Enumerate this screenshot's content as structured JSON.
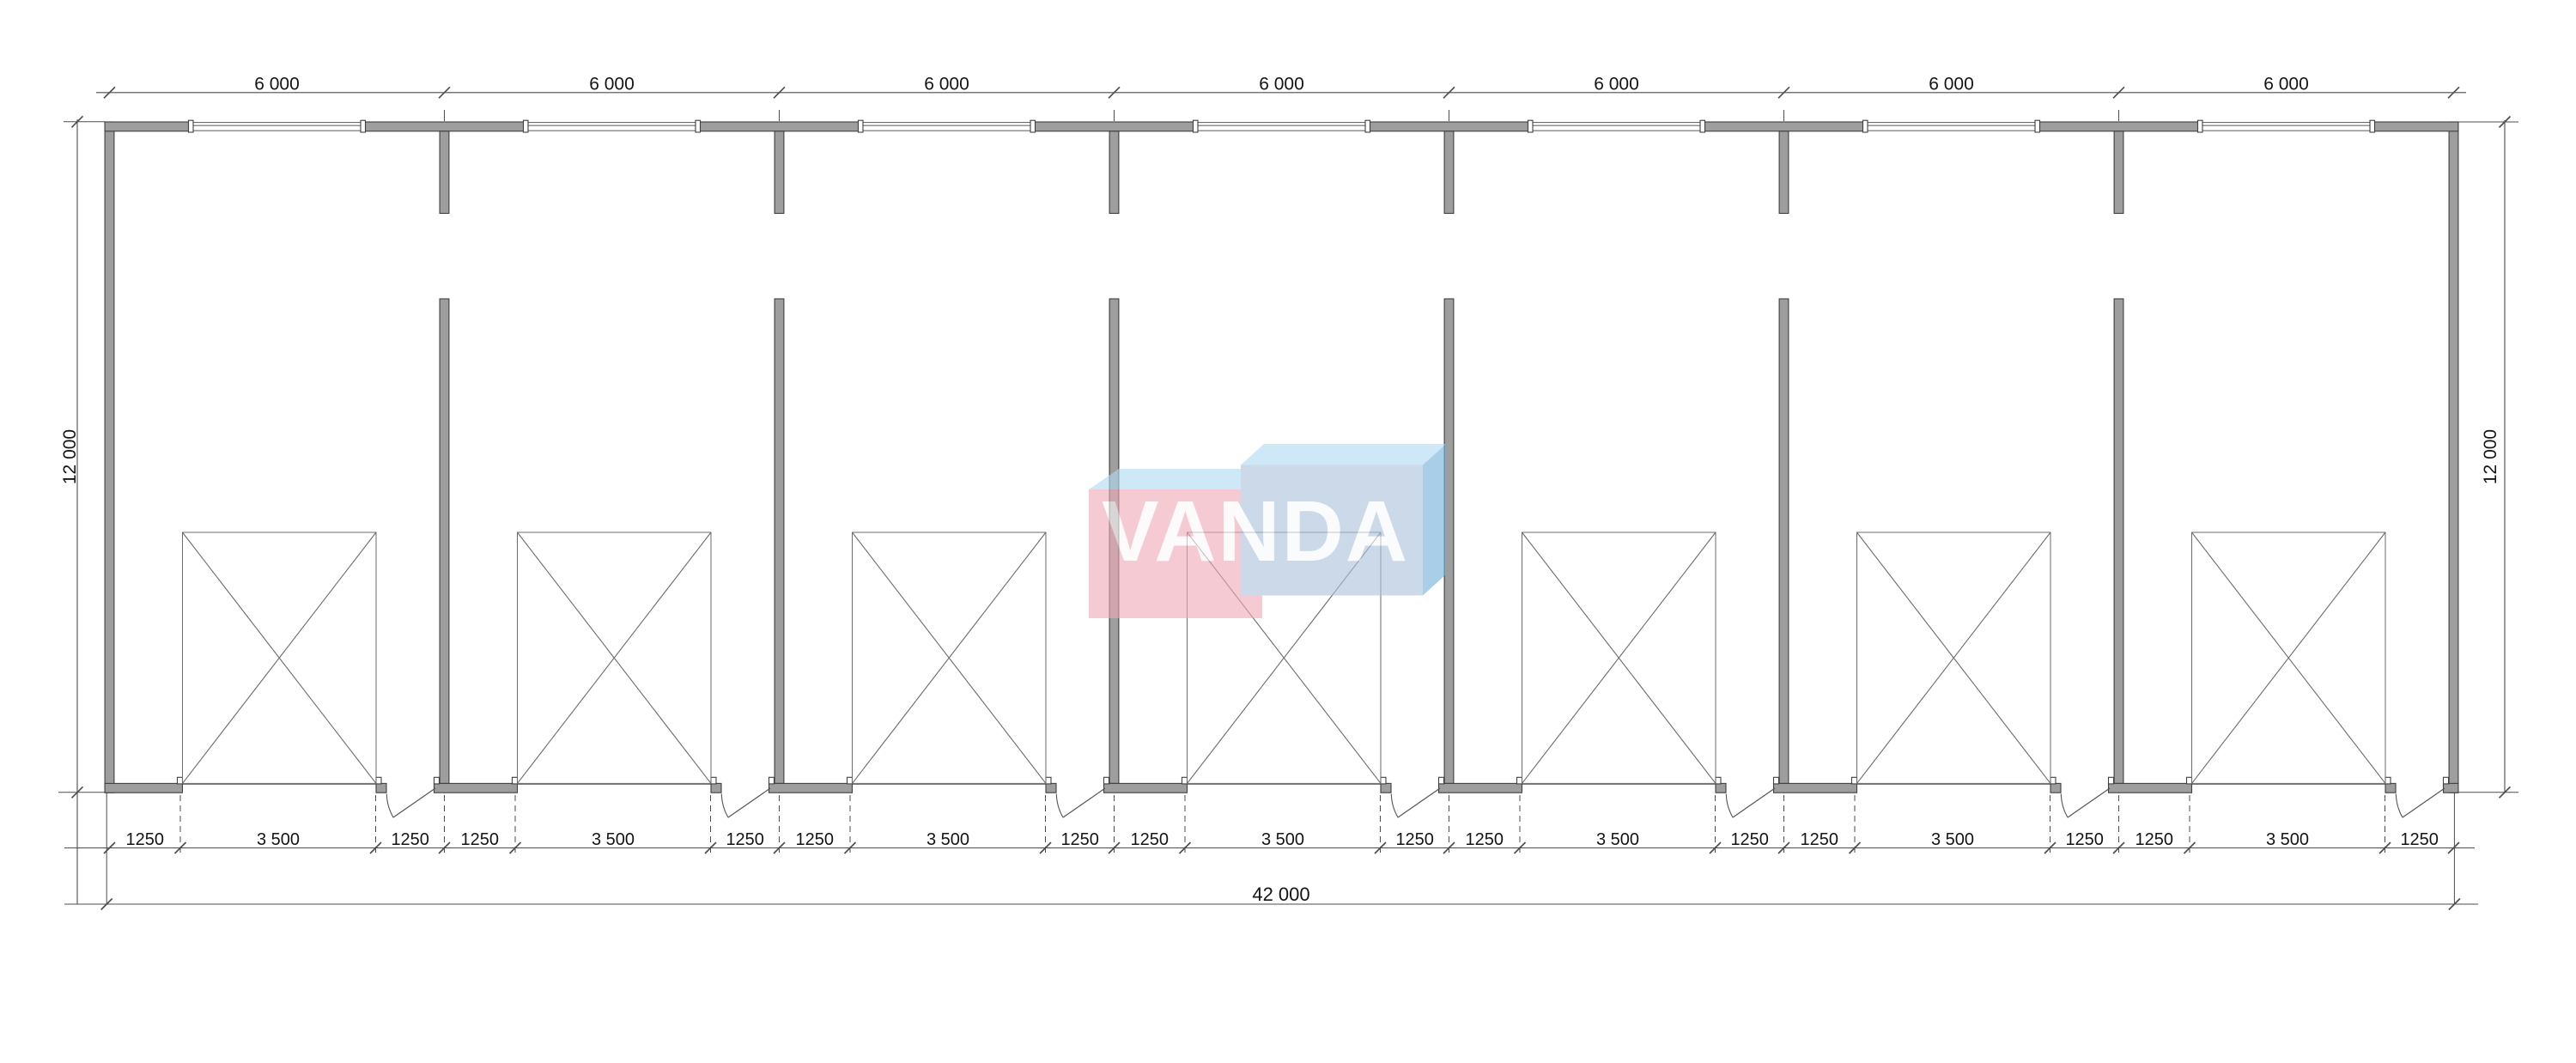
{
  "plan": {
    "bay_count": 7,
    "description_labels": {
      "bay_width_mm": "6 000",
      "door_zone_mm": "1250",
      "garage_opening_mm": "3 500",
      "total_width_mm": "42 000",
      "depth_mm": "12 000"
    }
  },
  "dimensions": {
    "top": [
      "6 000",
      "6 000",
      "6 000",
      "6 000",
      "6 000",
      "6 000",
      "6 000"
    ],
    "bottom_per_bay": [
      [
        "1250",
        "3 500",
        "1250"
      ],
      [
        "1250",
        "3 500",
        "1250"
      ],
      [
        "1250",
        "3 500",
        "1250"
      ],
      [
        "1250",
        "3 500",
        "1250"
      ],
      [
        "1250",
        "3 500",
        "1250"
      ],
      [
        "1250",
        "3 500",
        "1250"
      ],
      [
        "1250",
        "3 500",
        "1250"
      ]
    ],
    "total_width": "42 000",
    "left_depth": "12 000",
    "right_depth": "12 000"
  },
  "logo": {
    "text": "VANDA",
    "text_color": "#ffffff",
    "left_front_color": "#f0abb8",
    "right_front_color": "#adc2db",
    "top_face_color": "#b1dbf3",
    "side_face_color": "#74b1da",
    "opacity": 0.62
  },
  "colors": {
    "background": "#ffffff",
    "wall_fill": "#9e9e9e",
    "wall_outline": "#3f3f3f",
    "dim_line": "#4d4d4d",
    "thin_line": "#6b6b6b",
    "text": "#141414"
  }
}
